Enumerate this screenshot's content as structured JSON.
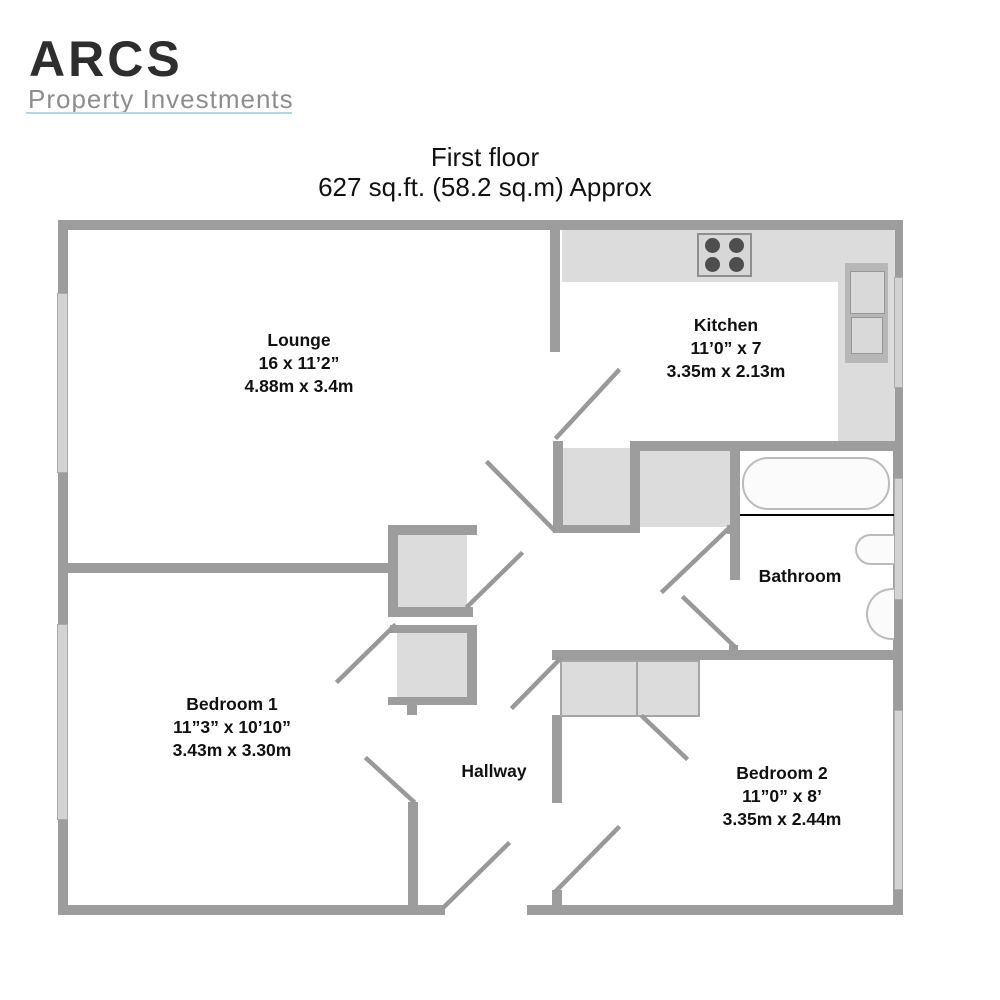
{
  "brand": {
    "name": "ARCS",
    "tagline": "Property Investments"
  },
  "title": {
    "floor": "First floor",
    "area": "627 sq.ft. (58.2 sq.m) Approx"
  },
  "rooms": {
    "lounge": {
      "name": "Lounge",
      "imperial": "16 x 11’2”",
      "metric": "4.88m x 3.4m"
    },
    "kitchen": {
      "name": "Kitchen",
      "imperial": "11’0” x 7",
      "metric": "3.35m x 2.13m"
    },
    "bathroom": {
      "name": "Bathroom"
    },
    "bedroom1": {
      "name": "Bedroom 1",
      "imperial": "11”3” x 10’10”",
      "metric": "3.43m x 3.30m"
    },
    "bedroom2": {
      "name": "Bedroom 2",
      "imperial": "11”0” x 8’",
      "metric": "3.35m x 2.44m"
    },
    "hallway": {
      "name": "Hallway"
    }
  },
  "fixtures": [
    "hob-4-burners",
    "kitchen-sink-unit",
    "bath",
    "basin",
    "toilet",
    "built-in-cupboards",
    "windows",
    "door-swings"
  ],
  "colors": {
    "wall": "#9d9d9d",
    "fill": "#dcdcdc",
    "window": "#d3d3d3",
    "windowBorder": "#ababab",
    "fixture": "#fbfbfb",
    "fixtureBorder": "#bbbbbb",
    "boxBorder": "#a5a5a5",
    "burner": "#4e4e4e",
    "door": "#999999",
    "brandInk": "#2e2e2e",
    "brandGray": "#8e8e8e",
    "accent": "#b2d7de"
  }
}
